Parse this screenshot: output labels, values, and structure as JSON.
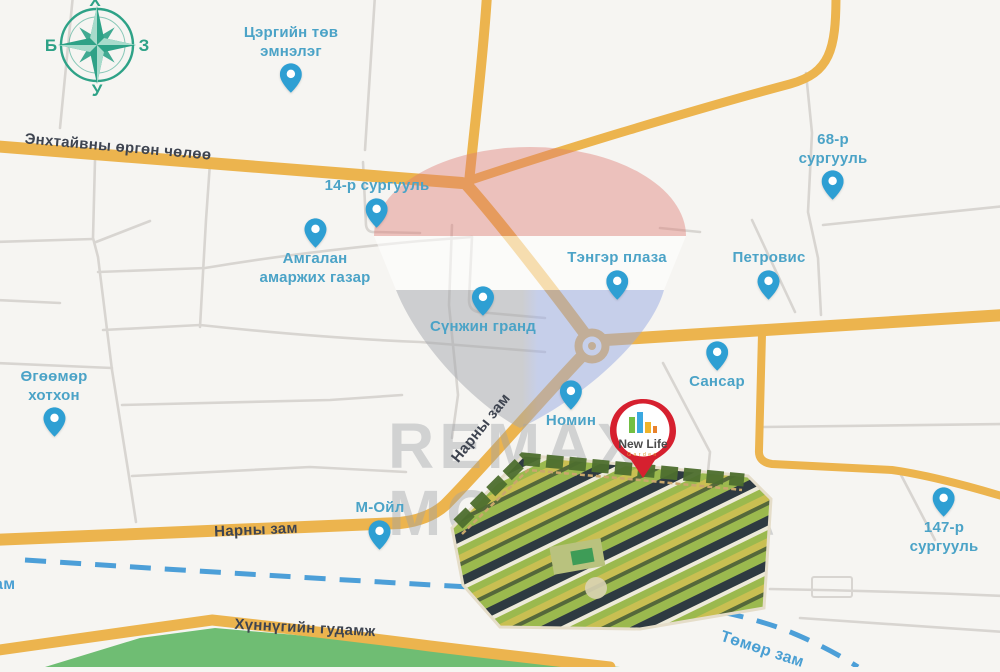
{
  "map": {
    "compass": {
      "north": "Х",
      "east": "З",
      "south": "У",
      "west": "Б"
    },
    "watermark": {
      "line1": "REMAX",
      "line2": "MONGOLIA"
    },
    "project_pin": {
      "name": "New Life",
      "subtitle": "Garden"
    },
    "pois": [
      {
        "label": "Цэргийн төв\nэмнэлэг"
      },
      {
        "label": "14-р сургууль"
      },
      {
        "label": "68-р\nсургууль"
      },
      {
        "label": "Амгалан\nамаржих газар"
      },
      {
        "label": "Тэнгэр плаза"
      },
      {
        "label": "Петровис"
      },
      {
        "label": "Сүнжин гранд"
      },
      {
        "label": "Сансар"
      },
      {
        "label": "Номин"
      },
      {
        "label": "Өгөөмөр\nхотхон"
      },
      {
        "label": "М-Ойл"
      },
      {
        "label": "147-р\nсургууль"
      }
    ],
    "road_labels": [
      {
        "text": "Энхтайвны өргөн чөлөө"
      },
      {
        "text": "Нарны зам"
      },
      {
        "text": "Нарны зам"
      },
      {
        "text": "Хүннүгийн гудамж"
      },
      {
        "text": "Төмөр зам"
      },
      {
        "text": "зам"
      }
    ],
    "colors": {
      "road_yellow": "#ECB44E",
      "road_gray": "#D8D5D1",
      "railway_blue": "#4C9FD8",
      "pin_blue": "#2E9FD3",
      "poi_label_blue": "#4BA3C7",
      "compass_teal": "#2EA287",
      "green_area": "#6FBD73",
      "project_red": "#D6202F",
      "background": "#F6F5F2"
    }
  }
}
